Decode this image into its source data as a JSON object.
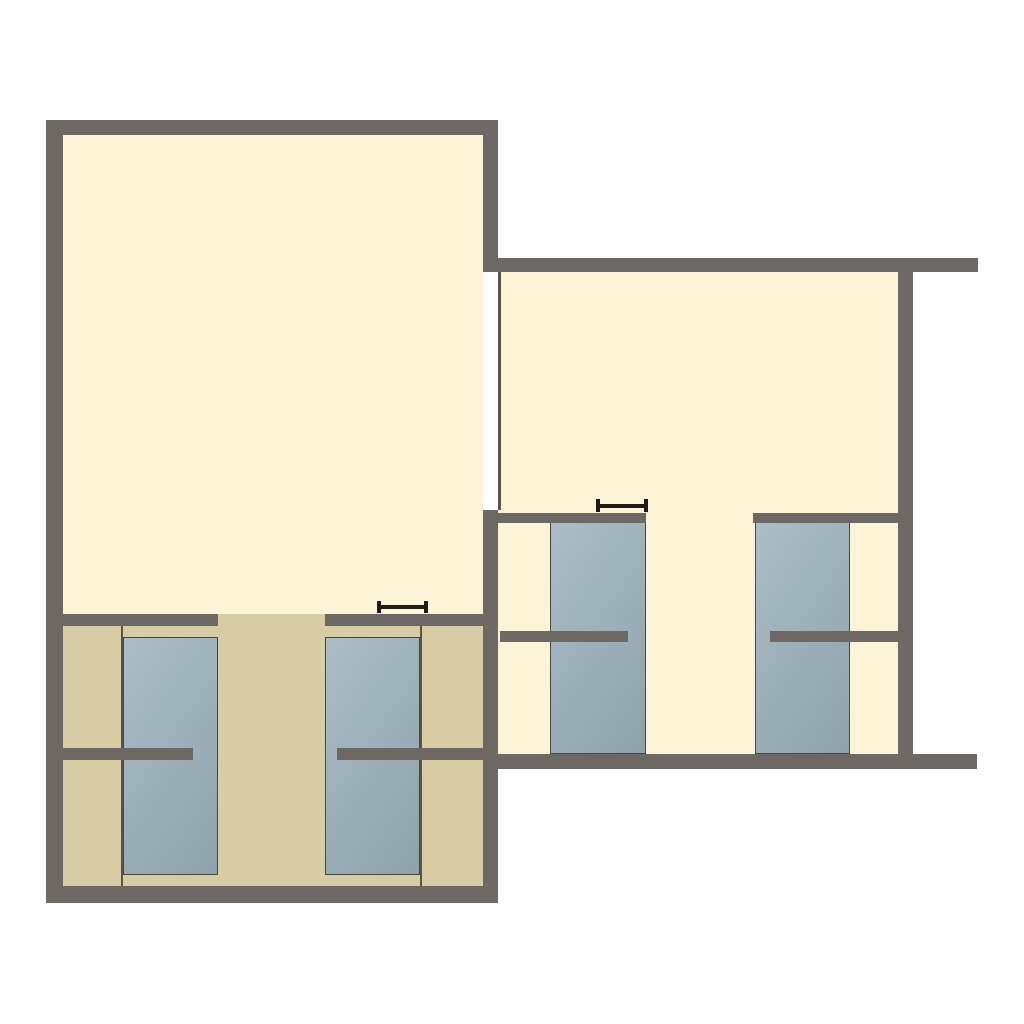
{
  "document": {
    "type": "floor-plan",
    "description": "Two-room floor plan with sleeping alcoves, four bed platforms, partition stub walls, a doorway opening between rooms and two opening-width markers.",
    "visible_text": []
  },
  "palette": {
    "background": "#ffffff",
    "wall": "#6e6864",
    "floor": "#fdf4d8",
    "alcove_floor": "#d7cca3",
    "bed_gradient_start": "#abbec8",
    "bed_gradient_end": "#8ea2ac",
    "bed_border": "#4a463c",
    "thin_line": "#59544c",
    "marker": "#1f1c17",
    "opening": "#ffffff"
  },
  "canvas": {
    "width": 1024,
    "height": 1024
  },
  "elements": [
    {
      "name": "left-room-floor",
      "kind": "floor",
      "rect": [
        63,
        135,
        420,
        479
      ]
    },
    {
      "name": "alcove-floor",
      "kind": "alcove",
      "rect": [
        63,
        614,
        420,
        272
      ]
    },
    {
      "name": "right-room-floor",
      "kind": "floor",
      "rect": [
        498,
        272,
        400,
        482
      ]
    },
    {
      "name": "doorway-opening",
      "kind": "opening",
      "rect": [
        483,
        272,
        15,
        238
      ]
    },
    {
      "name": "doorway-jamb-line",
      "kind": "thin",
      "rect": [
        498,
        272,
        3,
        238
      ]
    },
    {
      "name": "alcove-left-partition-line",
      "kind": "thin",
      "rect": [
        121,
        626,
        2,
        260
      ]
    },
    {
      "name": "alcove-right-partition-line",
      "kind": "thin",
      "rect": [
        420,
        626,
        2,
        260
      ]
    },
    {
      "name": "bed-left-room-1",
      "kind": "bed",
      "rect": [
        123,
        637,
        95,
        238
      ]
    },
    {
      "name": "bed-left-room-2",
      "kind": "bed",
      "rect": [
        325,
        637,
        95,
        238
      ]
    },
    {
      "name": "bed-right-room-1",
      "kind": "bed",
      "rect": [
        550,
        522,
        96,
        232
      ]
    },
    {
      "name": "bed-right-room-2",
      "kind": "bed",
      "rect": [
        755,
        522,
        95,
        232
      ]
    },
    {
      "name": "alcove-wall-left-segment",
      "kind": "wall",
      "rect": [
        63,
        614,
        155,
        12
      ]
    },
    {
      "name": "alcove-wall-right-segment",
      "kind": "wall",
      "rect": [
        325,
        614,
        158,
        12
      ]
    },
    {
      "name": "alcove-stub-wall-left",
      "kind": "wall",
      "rect": [
        63,
        748,
        130,
        12
      ]
    },
    {
      "name": "alcove-stub-wall-right",
      "kind": "wall",
      "rect": [
        337,
        748,
        146,
        12
      ]
    },
    {
      "name": "right-room-bed-wall-left",
      "kind": "wall",
      "rect": [
        498,
        513,
        148,
        10
      ]
    },
    {
      "name": "right-room-bed-wall-right",
      "kind": "wall",
      "rect": [
        753,
        513,
        145,
        10
      ]
    },
    {
      "name": "right-room-stub-wall-left",
      "kind": "wall",
      "rect": [
        500,
        631,
        128,
        11
      ]
    },
    {
      "name": "right-room-stub-wall-right",
      "kind": "wall",
      "rect": [
        770,
        631,
        128,
        11
      ]
    },
    {
      "name": "outer-wall-top-left-room",
      "kind": "wall",
      "rect": [
        46,
        120,
        452,
        15
      ]
    },
    {
      "name": "outer-wall-west",
      "kind": "wall",
      "rect": [
        46,
        120,
        17,
        783
      ]
    },
    {
      "name": "outer-wall-bottom-left-room",
      "kind": "wall",
      "rect": [
        46,
        886,
        452,
        17
      ]
    },
    {
      "name": "divider-wall-upper",
      "kind": "wall",
      "rect": [
        483,
        135,
        15,
        137
      ]
    },
    {
      "name": "divider-wall-lower",
      "kind": "wall",
      "rect": [
        483,
        510,
        15,
        376
      ]
    },
    {
      "name": "outer-wall-top-right-room",
      "kind": "wall",
      "rect": [
        483,
        258,
        495,
        14
      ]
    },
    {
      "name": "outer-wall-east",
      "kind": "wall",
      "rect": [
        898,
        272,
        15,
        482
      ]
    },
    {
      "name": "outer-wall-bottom-right-room",
      "kind": "wall",
      "rect": [
        498,
        754,
        479,
        15
      ]
    },
    {
      "name": "opening-width-marker-left-room",
      "kind": "marker",
      "rect": [
        377,
        601,
        51,
        12
      ]
    },
    {
      "name": "opening-width-marker-right-room",
      "kind": "marker",
      "rect": [
        596,
        499,
        52,
        13
      ]
    }
  ]
}
